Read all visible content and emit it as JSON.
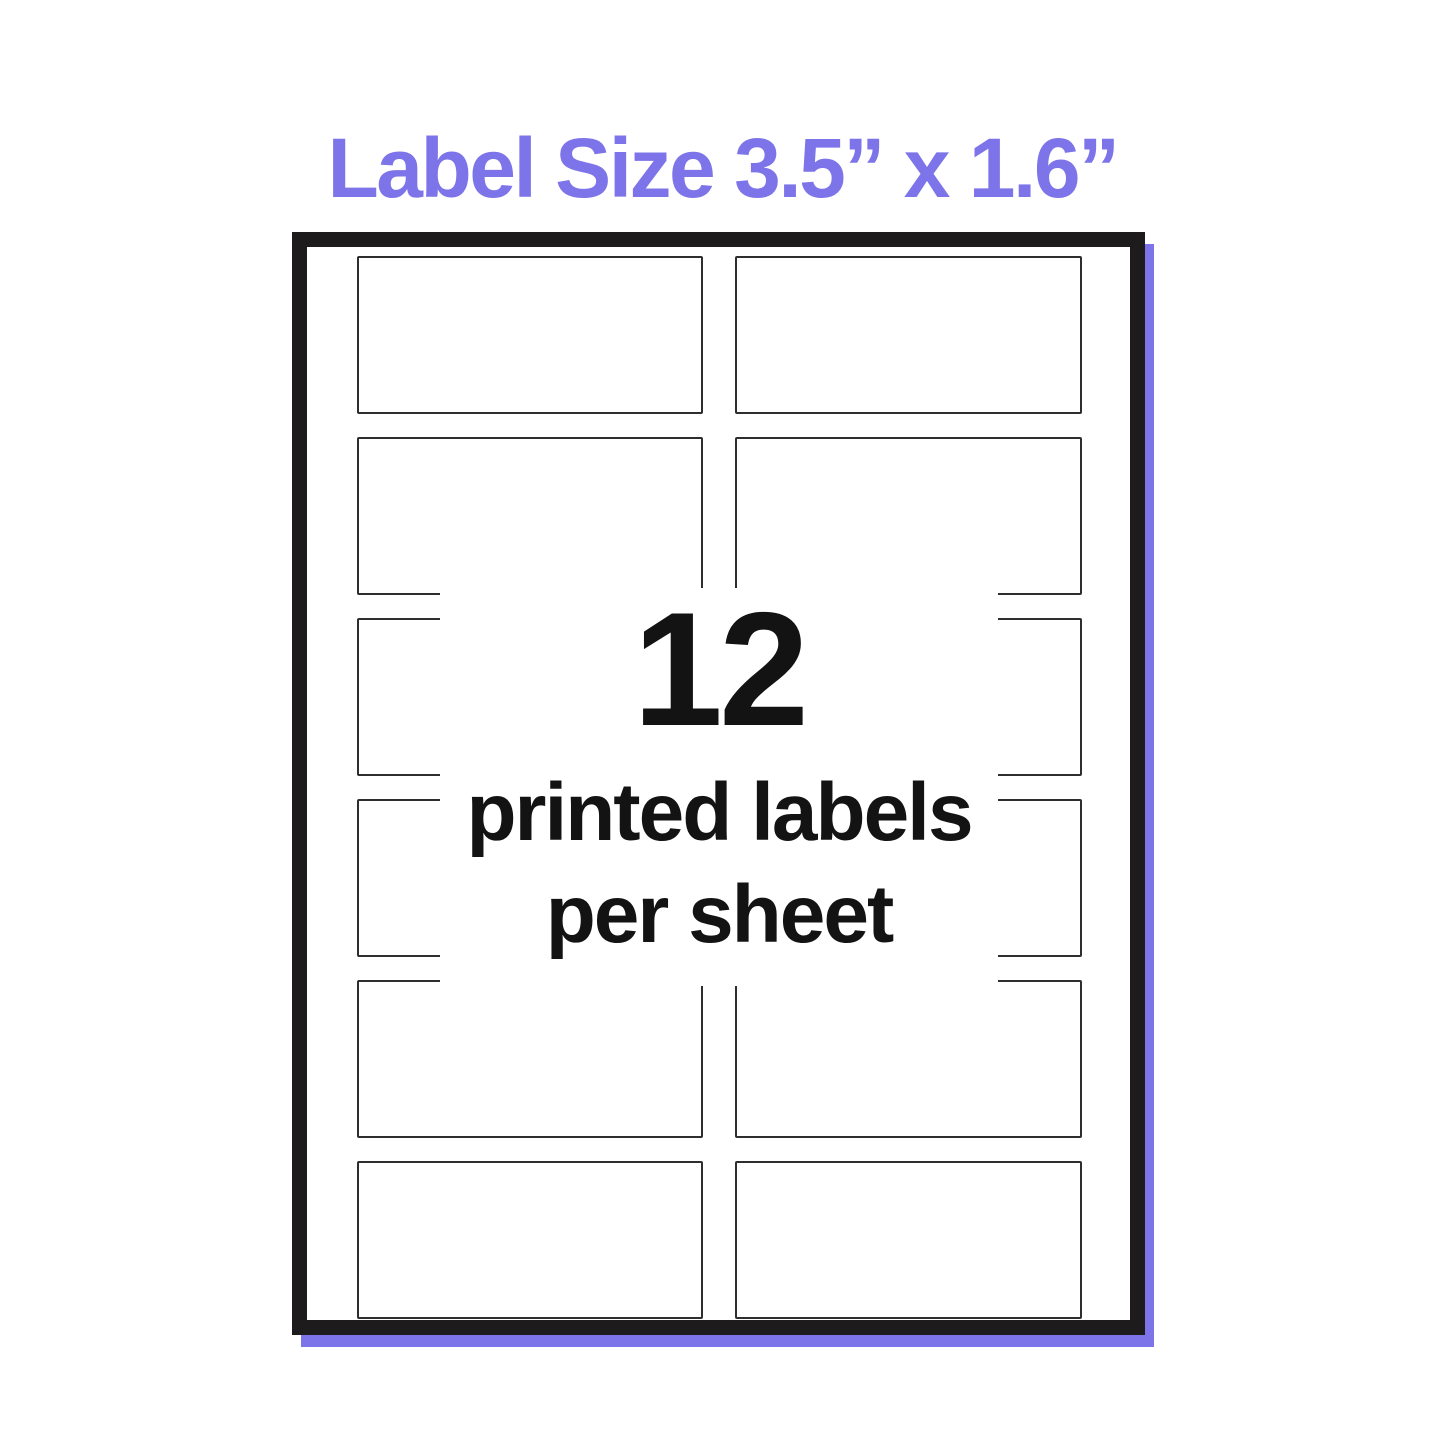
{
  "title": "Label Size 3.5” x 1.6”",
  "colors": {
    "accent": "#7E74E9",
    "sheet_border": "#1D1B1B",
    "label_outline": "#2E2E2E",
    "text": "#131313"
  },
  "sheet": {
    "grid": {
      "rows": 6,
      "columns": 2,
      "total_labels": 12
    },
    "callout": {
      "count": "12",
      "line1": "printed labels",
      "line2": "per sheet"
    }
  }
}
